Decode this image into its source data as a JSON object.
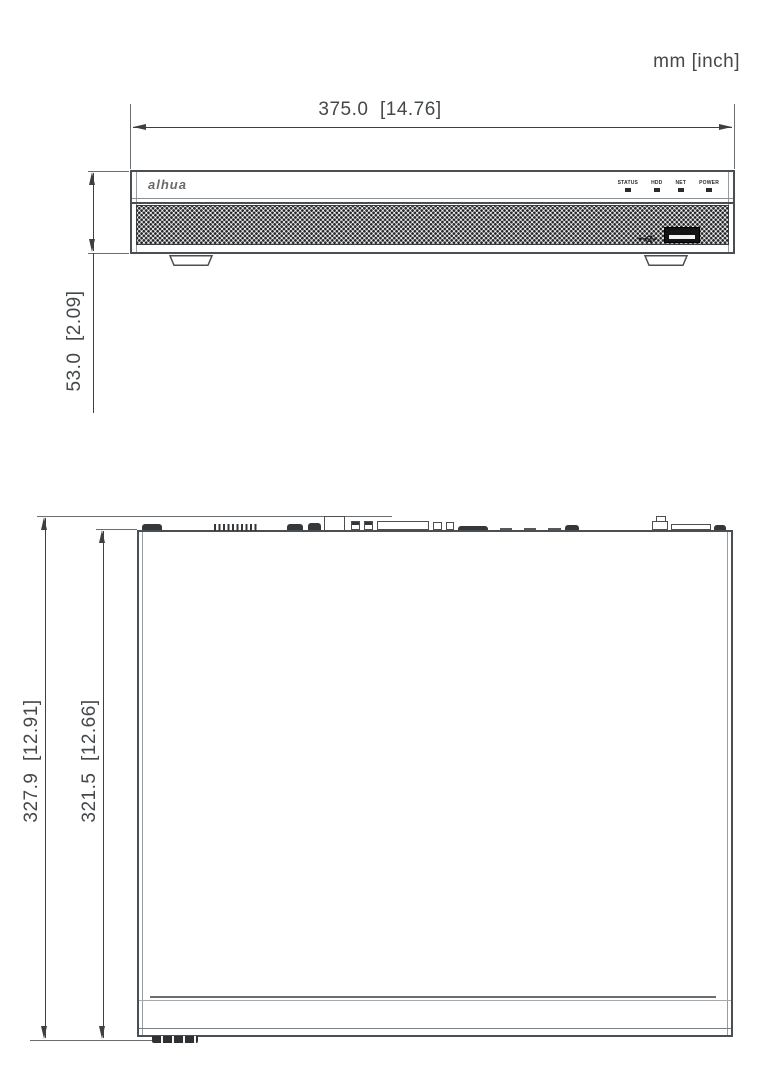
{
  "units_label": "mm [inch]",
  "ink_color": "#4b4f52",
  "front_view": {
    "brand_logo": "alhua",
    "width_dim_label": "375.0  [14.76]",
    "height_dim_label": "53.0  [2.09]",
    "leds": [
      {
        "label": "STATUS"
      },
      {
        "label": "HDD"
      },
      {
        "label": "NET"
      },
      {
        "label": "POWER"
      }
    ],
    "usb_port_icon": "usb-trident-icon"
  },
  "top_view": {
    "overall_depth_dim_label": "327.9  [12.91]",
    "body_depth_dim_label": "321.5  [12.66]"
  }
}
